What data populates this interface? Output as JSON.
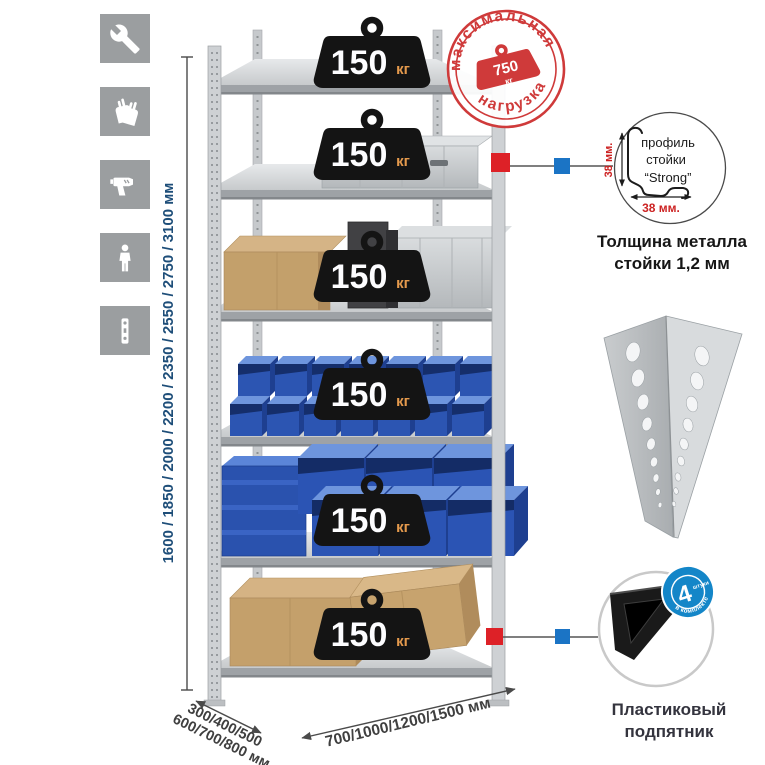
{
  "sidebar": {
    "icons": [
      {
        "name": "wrench-icon"
      },
      {
        "name": "gloves-icon"
      },
      {
        "name": "drill-icon"
      },
      {
        "name": "person-icon"
      },
      {
        "name": "perforated-post-icon"
      }
    ]
  },
  "rack": {
    "shelf_count": 6,
    "load_per_shelf": "150",
    "load_unit": "кг",
    "heights_label": "1600 / 1850 / 2000 / 2200 / 2350 / 2550 / 2750 / 3100 мм",
    "depth_label_line1": "300/400/500",
    "depth_label_line2": "600/700/800 мм",
    "width_label": "700/1000/1200/1500 мм"
  },
  "stamp": {
    "arc_top": "максимальная",
    "arc_bottom": "нагрузка",
    "value": "750",
    "unit": "кг"
  },
  "profile_detail": {
    "label_line1": "профиль",
    "label_line2": "стойки",
    "label_line3": "“Strong”",
    "dim_vertical": "38 мм.",
    "dim_horizontal": "38 мм.",
    "caption_line1": "Толщина металла",
    "caption_line2": "стойки 1,2 мм"
  },
  "foot_detail": {
    "badge_value": "4",
    "badge_small": "штуки",
    "badge_arc": "в комплекте",
    "caption_line1": "Пластиковый",
    "caption_line2": "подпятник"
  },
  "colors": {
    "stamp_red": "#cf3a3a",
    "marker_red": "#dd2127",
    "marker_blue": "#1b74c5",
    "bin_blue": "#2c55b2",
    "dim_text_blue": "#1e4e79",
    "badge_black": "#141414",
    "foot_badge_blue": "#1486c8",
    "tile_gray": "#9b9ea0"
  }
}
